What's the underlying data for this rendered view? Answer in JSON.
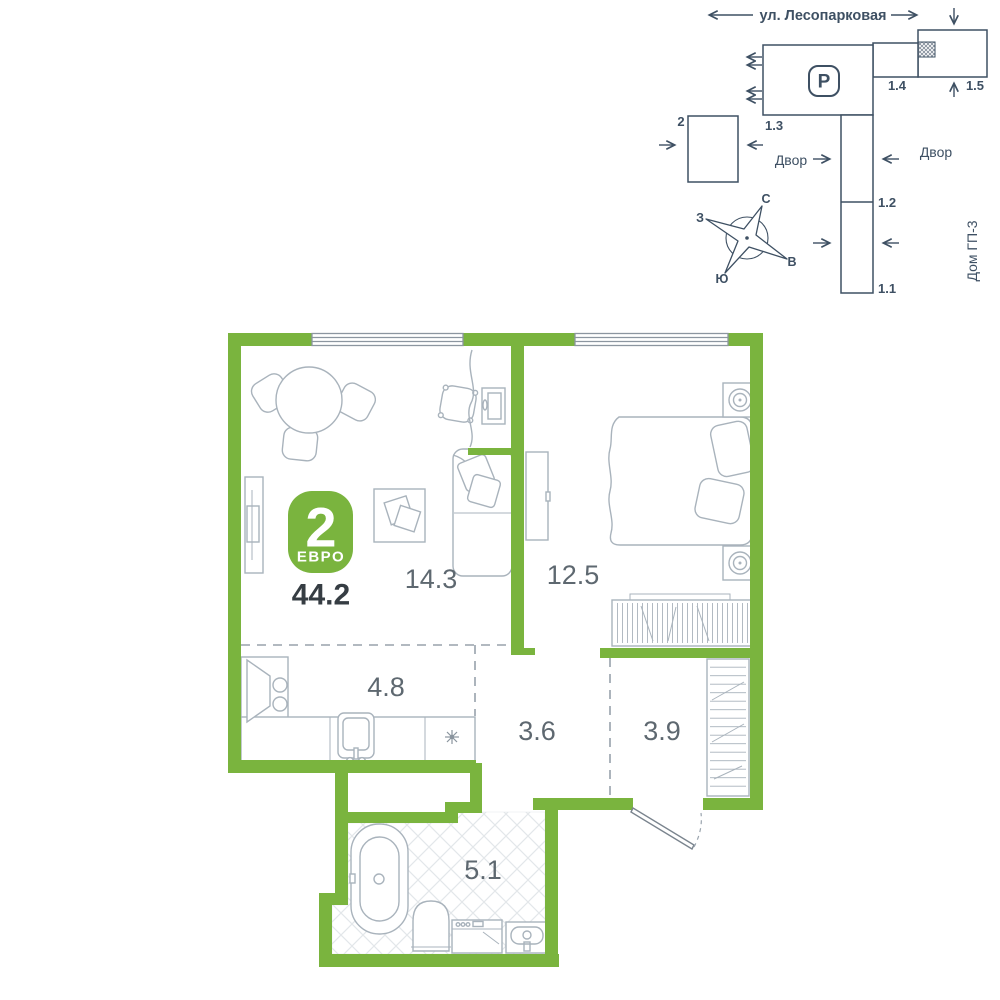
{
  "colors": {
    "wall_green": "#7AB43E",
    "site_navy": "#3E5063",
    "furniture_gray": "#A9B3BC",
    "room_label_gray": "#5E6870",
    "total_area_dark": "#363D43",
    "tile_gray": "#E3E7EA",
    "badge_text_white": "#FFFFFF"
  },
  "site_plan": {
    "street_label": "ул. Лесопарковая",
    "parking_symbol": "P",
    "building_labels": {
      "b2": "2",
      "b1_1": "1.1",
      "b1_2": "1.2",
      "b1_3": "1.3",
      "b1_4": "1.4",
      "b1_5": "1.5"
    },
    "courtyard_left": "Двор",
    "courtyard_right": "Двор",
    "house_label": "Дом ГП-3",
    "compass": {
      "north": "С",
      "south": "Ю",
      "west": "З",
      "east": "В"
    }
  },
  "apartment": {
    "badge": {
      "rooms_count": "2",
      "layout_type": "ЕВРО",
      "total_area": "44.2"
    },
    "rooms": {
      "living_room": "14.3",
      "bedroom": "12.5",
      "kitchen": "4.8",
      "hallway": "3.6",
      "corridor": "3.9",
      "bathroom": "5.1"
    }
  }
}
